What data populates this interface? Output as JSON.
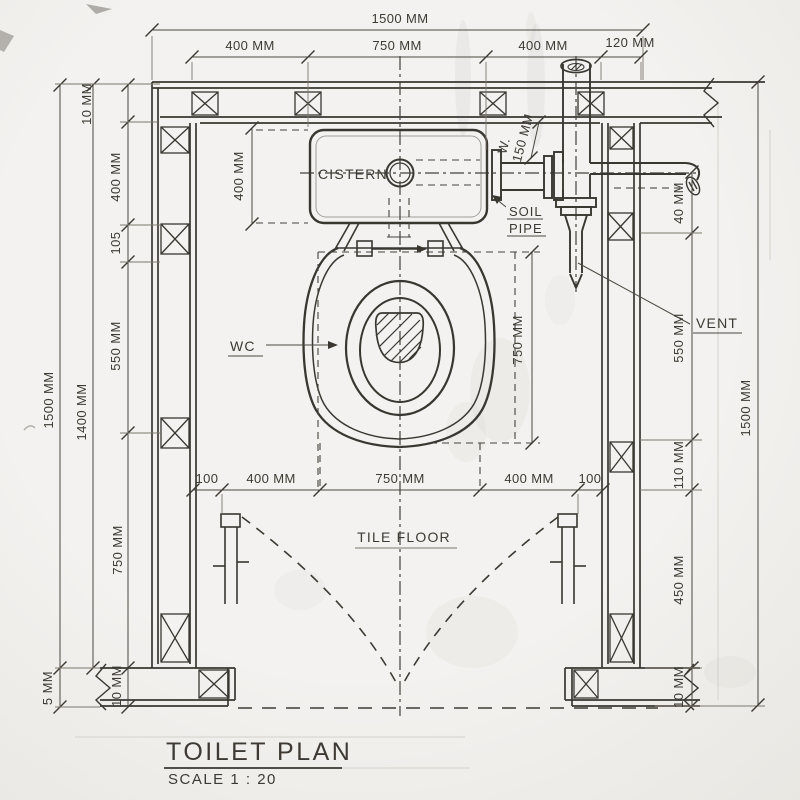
{
  "drawing": {
    "title": "TOILET PLAN",
    "scale_label": "SCALE 1 : 20",
    "labels": {
      "cistern": "CISTERN",
      "wc": "WC",
      "soil_line1": "SOIL",
      "soil_line2": "PIPE",
      "vent": "VENT",
      "tile_floor": "TILE FLOOR",
      "waste_abbr": "W."
    },
    "dims": {
      "top_total": "1500 MM",
      "top_segments": [
        "400 MM",
        "750 MM",
        "400 MM",
        "120 MM"
      ],
      "left_outer": "1500 MM",
      "left_inner": "1400 MM",
      "left_chain": [
        "10 MM",
        "400 MM",
        "105",
        "550 MM",
        "750 MM",
        "10 MM"
      ],
      "left_bottom": "5 MM",
      "right_outer": "1500 MM",
      "right_chain": [
        "40 MM",
        "550 MM",
        "110 MM",
        "450 MM",
        "10 MM"
      ],
      "cistern_height": "400 MM",
      "wc_depth": "750 MM",
      "soil_drop": "150 MM",
      "floor_segments": [
        "100",
        "400 MM",
        "750 MM",
        "400 MM",
        "100"
      ]
    },
    "colors": {
      "ink": "#3a3731",
      "paper": "#f1f0ed"
    }
  }
}
